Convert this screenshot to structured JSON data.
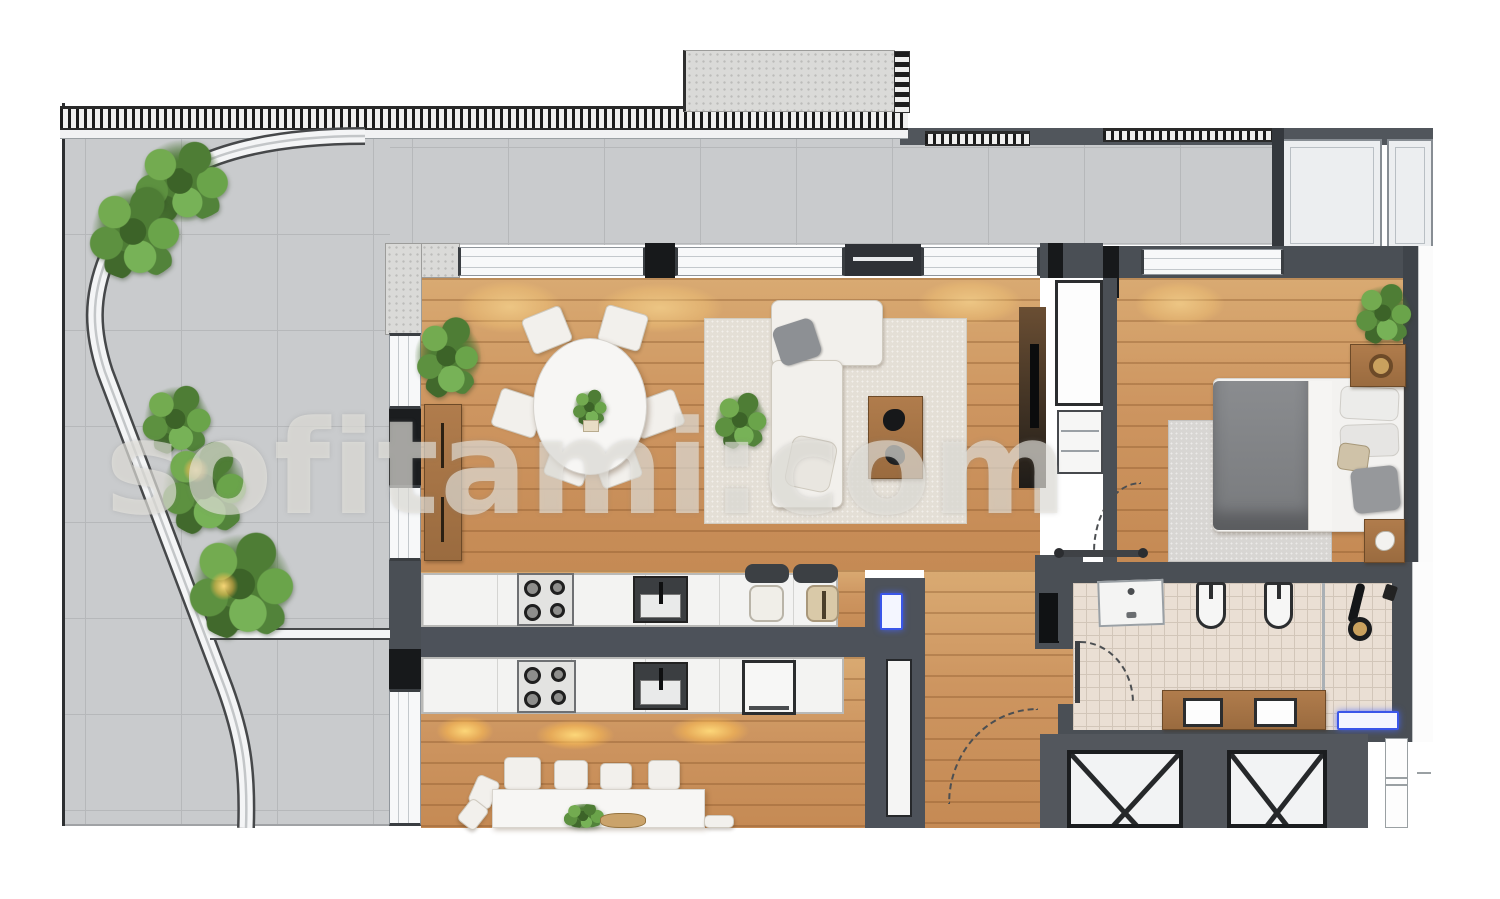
{
  "watermark": {
    "text": "sofitami:com"
  },
  "plan": {
    "type": "residential floor plan, rendered top-down view, cropped at bottom and right",
    "rooms": [
      {
        "name": "terrace",
        "side": "left",
        "features": [
          "gray concrete tile paving",
          "curved white walkway",
          "shrubs and palm plants",
          "two warm garden lights",
          "balustrade railing along top edge"
        ]
      },
      {
        "name": "living-dining-room",
        "features": [
          "oval dining table with six chairs",
          "L-shaped cream sofa on beige rug",
          "wood coffee table",
          "sideboard",
          "indoor plants",
          "window wall to terrace",
          "TV wall with cabinets"
        ]
      },
      {
        "name": "kitchen",
        "features": [
          "island counter with 4-burner cooktop and sink",
          "two bar stools",
          "second mirrored counter row of lower unit with cooktop, sink and appliance"
        ]
      },
      {
        "name": "lower-unit-dining",
        "features": [
          "white rectangular table with chairs and plant centerpiece, cut off at image bottom"
        ]
      },
      {
        "name": "bedroom",
        "side": "top-right",
        "features": [
          "double bed with gray duvet and pillows",
          "two wood nightstands",
          "plant",
          "rug",
          "balcony with glass panels above"
        ]
      },
      {
        "name": "bathroom",
        "features": [
          "vanity",
          "two wall-hung toilets",
          "shower with black fixture",
          "beige mosaic tile floor",
          "door swing arc"
        ]
      },
      {
        "name": "elevator-core",
        "features": [
          "two elevator shafts drawn with X crosses"
        ]
      }
    ],
    "colors": {
      "wall": "#4a4f55",
      "wall_black": "#17191b",
      "wood_floor": "#cd9560",
      "terrace_tile": "#c9cbcd",
      "bath_tile": "#eadfd4",
      "furniture_white": "#f2f0ec",
      "furniture_wood": "#a9794b",
      "plant_green": "#4e7d35",
      "light_glow": "#ffd87a",
      "accent_blue": "#3a56e8",
      "background": "#ffffff"
    }
  }
}
